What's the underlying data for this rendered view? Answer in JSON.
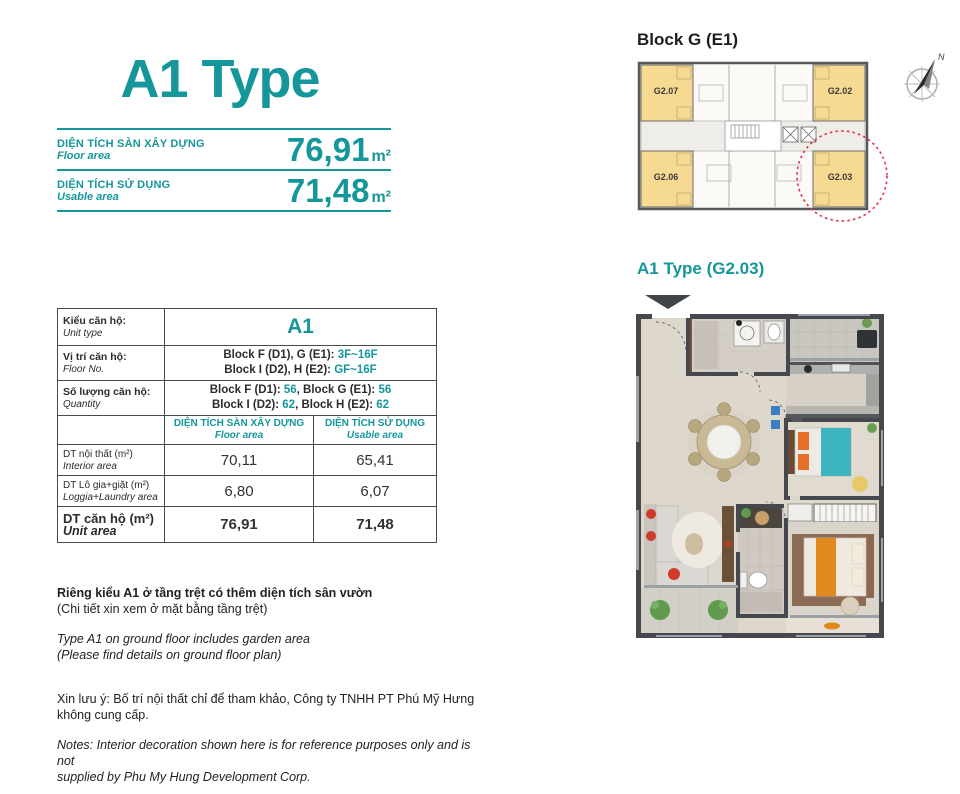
{
  "colors": {
    "accent_teal": "#14969B",
    "unit_highlight_yellow": "#F7DA92",
    "selection_circle_red": "#E8354F",
    "bed1_teal": "#3DB5C1",
    "bed_orange": "#E0891E"
  },
  "header": {
    "title": "A1 Type",
    "floor_area": {
      "label_vi": "DIỆN TÍCH SÀN XÂY DỰNG",
      "label_en": "Floor area",
      "value": "76,91",
      "unit": "m²"
    },
    "usable_area": {
      "label_vi": "DIỆN TÍCH SỬ DỤNG",
      "label_en": "Usable area",
      "value": "71,48",
      "unit": "m²"
    }
  },
  "spec_table": {
    "row_unit_type": {
      "label_vi": "Kiểu căn hộ:",
      "label_en": "Unit type",
      "value": "A1"
    },
    "row_floor_no": {
      "label_vi": "Vị trí căn hộ:",
      "label_en": "Floor No.",
      "line1_pre": "Block F (D1), G (E1): ",
      "line1_val": "3F~16F",
      "line2_pre": "Block I (D2), H (E2): ",
      "line2_val": "GF~16F"
    },
    "row_quantity": {
      "label_vi": "Số lượng căn hộ:",
      "label_en": "Quantity",
      "line1_p1": "Block F (D1): ",
      "line1_v1": "56",
      "line1_p2": ", Block G (E1): ",
      "line1_v2": "56",
      "line2_p1": "Block I (D2): ",
      "line2_v1": "62",
      "line2_p2": ", Block H (E2): ",
      "line2_v2": "62"
    },
    "col_headers": {
      "floor_vi": "DIỆN TÍCH SÀN XÂY DỰNG",
      "floor_en": "Floor area",
      "usable_vi": "DIỆN TÍCH SỬ DỤNG",
      "usable_en": "Usable area"
    },
    "area_rows": [
      {
        "label_vi": "DT nội thất  (m²)",
        "label_en": "Interior area",
        "floor": "70,11",
        "usable": "65,41"
      },
      {
        "label_vi": "DT Lô gia+giặt  (m²)",
        "label_en": "Loggia+Laundry area",
        "floor": "6,80",
        "usable": "6,07"
      },
      {
        "label_vi": "DT căn hộ (m²)",
        "label_en": "Unit area",
        "floor": "76,91",
        "usable": "71,48"
      }
    ]
  },
  "notes": {
    "garden_vi_1": "Riêng kiểu A1 ở tầng trệt có thêm diện tích sân vườn",
    "garden_vi_2": "(Chi tiết xin xem ở mặt bằng tầng trệt)",
    "garden_en_1": "Type A1 on ground floor includes garden area",
    "garden_en_2": "(Please find details on ground floor plan)",
    "disclaimer_vi_1": "Xin lưu ý: Bố trí nội thất chỉ để tham khảo, Công ty TNHH PT Phú Mỹ Hưng",
    "disclaimer_vi_2": "không cung cấp.",
    "disclaimer_en_1": "Notes: Interior decoration shown here is for reference purposes only and is not",
    "disclaimer_en_2": "supplied by Phu My Hung Development Corp."
  },
  "block_plan": {
    "title": "Block G (E1)",
    "units": [
      "G2.07",
      "G2.02",
      "G2.06",
      "G2.03"
    ],
    "highlighted_unit": "G2.03",
    "compass_label": "N"
  },
  "floor_plan": {
    "title": "A1 Type (G2.03)"
  }
}
